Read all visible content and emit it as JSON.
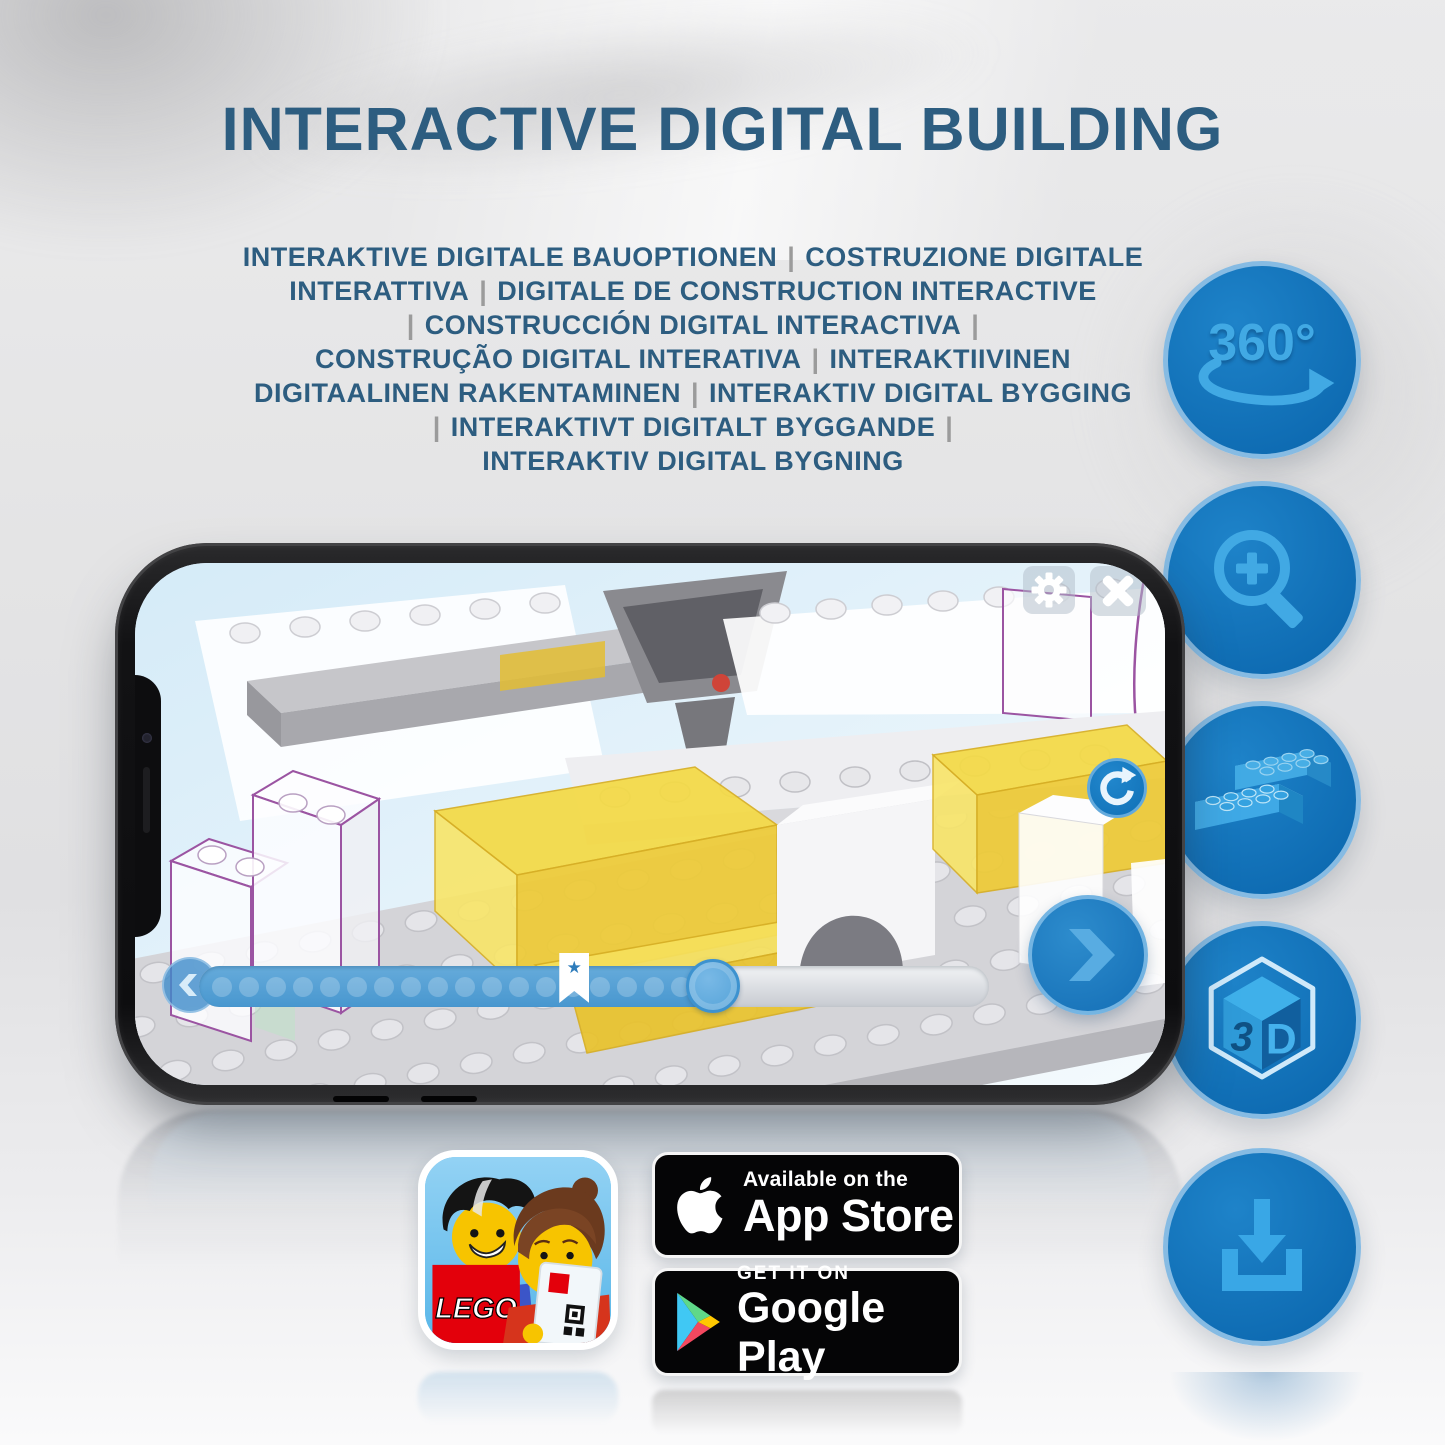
{
  "page": {
    "title": "INTERACTIVE DIGITAL BUILDING"
  },
  "subtitle": {
    "lines": [
      "INTERAKTIVE DIGITALE BAUOPTIONEN | COSTRUZIONE DIGITALE",
      "INTERATTIVA | DIGITALE DE CONSTRUCTION INTERACTIVE",
      "| CONSTRUCCIÓN DIGITAL INTERACTIVA |",
      "CONSTRUÇÃO DIGITAL INTERATIVA | INTERAKTIIVINEN",
      "DIGITAALINEN RAKENTAMINEN | INTERAKTIV DIGITAL BYGGING",
      "| INTERAKTIVT DIGITALT BYGGANDE |",
      "INTERAKTIV DIGITAL BYGNING"
    ]
  },
  "feature_icons": {
    "rotation_360": {
      "label": "360°"
    },
    "zoom": {
      "name": "zoom-in-magnifier"
    },
    "brick": {
      "name": "lego-bricks"
    },
    "cube_3d": {
      "left": "3",
      "right": "D"
    },
    "download": {
      "name": "download"
    }
  },
  "phone": {
    "progress": {
      "dot_count": 18,
      "filled_percent": 65,
      "bookmark_percent": 47.5
    }
  },
  "badges": {
    "app_store": {
      "tagline": "Available on the",
      "store": "App Store"
    },
    "google_play": {
      "tagline": "GET IT ON",
      "store": "Google Play"
    }
  },
  "lego_icon": {
    "logo_text": "LEGO"
  },
  "colors": {
    "title_blue": "#2d5d80",
    "separator_gray": "#9b9b9b",
    "accent_blue": "#1172ba",
    "icon_glyph_blue": "#41a9e4",
    "yellow_brick": "#f2d640",
    "purple_outline": "#9b54a2",
    "badge_black": "#050506"
  }
}
